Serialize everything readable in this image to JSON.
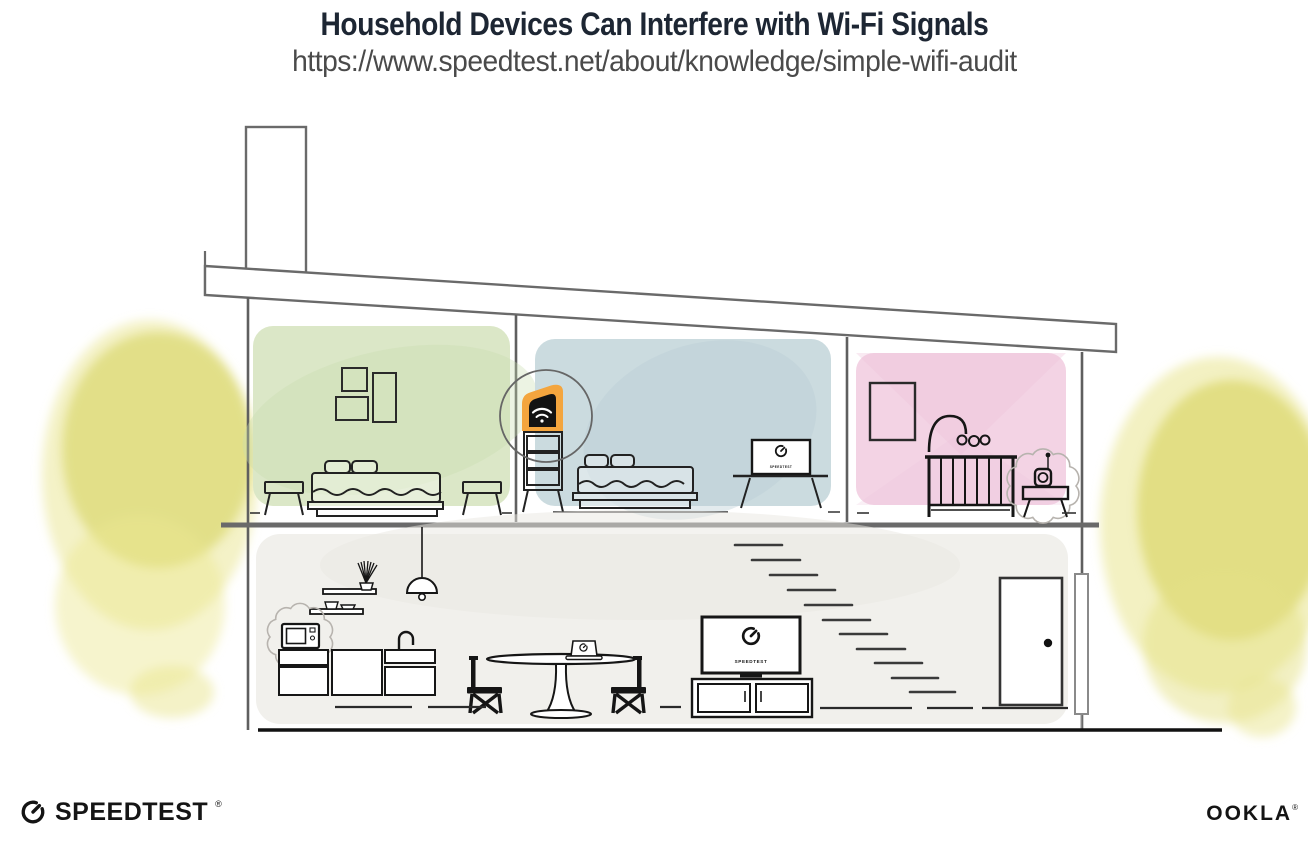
{
  "header": {
    "title": "Household Devices Can Interfere with Wi-Fi Signals",
    "url": "https://www.speedtest.net/about/knowledge/simple-wifi-audit"
  },
  "house": {
    "screen_label": "SPEEDTEST",
    "upper_rooms": [
      {
        "id": "bedroom-left",
        "wall_color": "#dbe7c7",
        "items": [
          "three-picture-frames",
          "double-bed",
          "two-stools"
        ]
      },
      {
        "id": "bedroom-middle",
        "wall_color": "#cbdbdf",
        "items": [
          "wifi-router-on-dresser",
          "highlight-circle",
          "double-bed",
          "tv-with-speedtest"
        ]
      },
      {
        "id": "nursery",
        "wall_color": "#f3d3e4",
        "items": [
          "picture-frame",
          "crib-with-mobile",
          "baby-monitor-with-interference"
        ]
      }
    ],
    "ground_floor": {
      "wall_color": "#f1f0ec",
      "items": [
        "microwave-with-interference",
        "kitchen-cabinets",
        "wall-shelves",
        "pendant-lamp",
        "dining-table-with-laptop",
        "two-chairs",
        "tv-on-console-with-speedtest",
        "staircase",
        "front-door",
        "downspout"
      ]
    },
    "interference_sources": [
      "microwave",
      "baby-monitor"
    ]
  },
  "colors": {
    "title": "#1d2633",
    "url": "#4a4a4a",
    "outline": "#5f5f5f",
    "ink": "#161616",
    "room_green": "#dbe7c7",
    "room_blue": "#cbdbdf",
    "room_pink": "#f3d3e4",
    "ground_gray": "#f1f0ec",
    "foliage_yellow": "#dfdb7c",
    "router_orange": "#f4a53e"
  },
  "footer": {
    "speedtest_wordmark": "SPEEDTEST",
    "speedtest_reg": "®",
    "ookla_wordmark": "OOKLA",
    "ookla_reg": "®"
  }
}
